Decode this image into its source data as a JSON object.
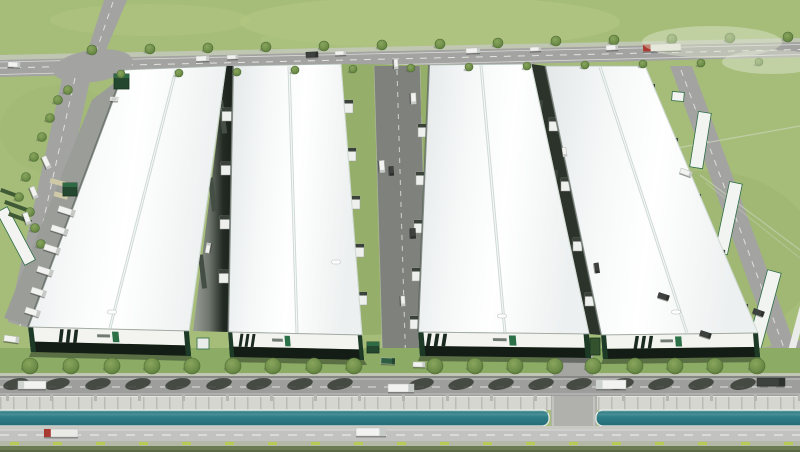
{
  "scene": {
    "title": "Aerial rendering of logistics industrial park",
    "description": "3D architectural aerial rendering of an industrial logistics park: four long white warehouse buildings with dark green facade bands and a small green brand mark, service roads with loading docks and trucks, tree-lined frontage road, a teal drainage canal along the highway, and surrounding green fields.",
    "meta": {
      "warehouse_count": 4,
      "branding": "small green chevron logo with illegible text on each facade"
    },
    "palette": {
      "grass": "#a6bd7a",
      "grass_mid": "#95af6a",
      "grass_dark": "#8cab64",
      "road": "#a3a3a1",
      "road_dark": "#7f827c",
      "road_light": "#c2c2c0",
      "frontage": "#9e9e9c",
      "concrete": "#cfcfc9",
      "water": "#2e7d86",
      "roof": "#f6f7f8",
      "facade_white": "#f3f3f0",
      "facade_dark": "#141d15",
      "green_trim": "#1d3a27",
      "brand_green": "#2c7047",
      "tree": "#6d8d48",
      "shadow": "#2e352d",
      "truck_white": "#f2f3f0",
      "truck_dark": "#3e423e",
      "truck_red": "#a93a31",
      "truck_green": "#2e5e40",
      "marker": "#b8cc55",
      "hedge": "#6d7b53"
    },
    "buildings": [
      {
        "id": "warehouse-1",
        "roof": [
          [
            124,
            70
          ],
          [
            226,
            66
          ],
          [
            189,
            331
          ],
          [
            28,
            327
          ]
        ],
        "facade": [
          [
            28,
            327
          ],
          [
            189,
            331
          ],
          [
            191,
            356
          ],
          [
            31,
            352
          ]
        ],
        "ridge": [
          176,
          70,
          110,
          328
        ],
        "vent": [
          112,
          312
        ],
        "stripes_u": 0.18,
        "logo_u": 0.52
      },
      {
        "id": "warehouse-2",
        "roof": [
          [
            233,
            66
          ],
          [
            341,
            64
          ],
          [
            362,
            335
          ],
          [
            228,
            332
          ]
        ],
        "facade": [
          [
            228,
            332
          ],
          [
            362,
            335
          ],
          [
            364,
            360
          ],
          [
            230,
            357
          ]
        ],
        "ridge": [
          289,
          66,
          297,
          333
        ],
        "vent": [
          336,
          262
        ],
        "stripes_u": 0.07,
        "logo_u": 0.42
      },
      {
        "id": "warehouse-3",
        "roof": [
          [
            429,
            65
          ],
          [
            531,
            64
          ],
          [
            589,
            334
          ],
          [
            418,
            332
          ]
        ],
        "facade": [
          [
            418,
            332
          ],
          [
            589,
            334
          ],
          [
            591,
            358
          ],
          [
            420,
            356
          ]
        ],
        "ridge": [
          481,
          65,
          505,
          333
        ],
        "vent": [
          502,
          316
        ],
        "stripes_u": 0.04,
        "logo_u": 0.53
      },
      {
        "id": "warehouse-4",
        "roof": [
          [
            545,
            66
          ],
          [
            645,
            66
          ],
          [
            758,
            333
          ],
          [
            601,
            335
          ]
        ],
        "facade": [
          [
            601,
            335
          ],
          [
            758,
            333
          ],
          [
            760,
            357
          ],
          [
            603,
            359
          ]
        ],
        "ridge": [
          600,
          67,
          687,
          333
        ],
        "vent": [
          676,
          312
        ],
        "stripes_u": 0.2,
        "logo_u": 0.47
      }
    ],
    "gaps": {
      "gap12": [
        [
          226,
          66
        ],
        [
          233,
          66
        ],
        [
          228,
          332
        ],
        [
          193,
          331
        ]
      ],
      "gap34": [
        [
          531,
          64
        ],
        [
          545,
          66
        ],
        [
          601,
          335
        ],
        [
          589,
          334
        ]
      ],
      "docks12": [
        [
          222,
          108
        ],
        [
          221,
          162
        ],
        [
          220,
          216
        ],
        [
          219,
          270
        ]
      ],
      "docks34": [
        [
          549,
          118
        ],
        [
          561,
          178
        ],
        [
          573,
          238
        ],
        [
          585,
          293
        ]
      ],
      "wallsegs12": [
        [
          218,
          100,
          -7
        ],
        [
          208,
          178,
          -7
        ],
        [
          198,
          255,
          -7
        ]
      ],
      "wallsegs34": [
        [
          538,
          100,
          5
        ],
        [
          553,
          170,
          5
        ],
        [
          569,
          245,
          5
        ]
      ]
    },
    "corridor": {
      "patches_left": [
        [
          358,
          86
        ],
        [
          361,
          176
        ],
        [
          364,
          268
        ]
      ],
      "patches_right": [
        [
          421,
          100
        ],
        [
          423,
          190
        ],
        [
          425,
          280
        ]
      ],
      "docks_west": [
        [
          344,
          100
        ],
        [
          347,
          148
        ],
        [
          351,
          196
        ],
        [
          355,
          244
        ],
        [
          358,
          292
        ]
      ],
      "docks_east": [
        [
          418,
          124
        ],
        [
          416,
          172
        ],
        [
          414,
          220
        ],
        [
          412,
          268
        ],
        [
          410,
          316
        ]
      ],
      "docks_b4east": [
        [
          645,
          84
        ],
        [
          668,
          138
        ],
        [
          691,
          194
        ],
        [
          715,
          250
        ],
        [
          738,
          304
        ]
      ]
    },
    "trees": {
      "top": [
        [
          92,
          50
        ],
        [
          121,
          74
        ],
        [
          150,
          49
        ],
        [
          179,
          73
        ],
        [
          208,
          48
        ],
        [
          237,
          72
        ],
        [
          266,
          47
        ],
        [
          295,
          70
        ],
        [
          324,
          46
        ],
        [
          353,
          69
        ],
        [
          382,
          45
        ],
        [
          411,
          68
        ],
        [
          440,
          44
        ],
        [
          469,
          67
        ],
        [
          498,
          43
        ],
        [
          527,
          66
        ],
        [
          556,
          41
        ],
        [
          585,
          65
        ],
        [
          614,
          40
        ],
        [
          643,
          64
        ],
        [
          672,
          39
        ],
        [
          701,
          63
        ],
        [
          730,
          38
        ],
        [
          759,
          62
        ],
        [
          788,
          37
        ]
      ],
      "left": [
        [
          58,
          100
        ],
        [
          50,
          118
        ],
        [
          42,
          137
        ],
        [
          34,
          157
        ],
        [
          26,
          177
        ],
        [
          19,
          197
        ],
        [
          68,
          90
        ],
        [
          30,
          212
        ],
        [
          35,
          228
        ],
        [
          41,
          244
        ]
      ],
      "front_xs": [
        30,
        71,
        112,
        152,
        192,
        233,
        273,
        314,
        354,
        435,
        475,
        515,
        555,
        593,
        635,
        675,
        715,
        757
      ],
      "front_y": 366,
      "front_r": 8
    },
    "trucks": [
      [
        196,
        56,
        13,
        5,
        -2,
        "white"
      ],
      [
        227,
        55,
        11,
        4,
        -2,
        "white"
      ],
      [
        306,
        52,
        12,
        5,
        -2,
        "dark"
      ],
      [
        335,
        51,
        11,
        4,
        -2,
        "white"
      ],
      [
        466,
        48,
        14,
        5,
        -2,
        "white"
      ],
      [
        530,
        47,
        11,
        4,
        -2,
        "white"
      ],
      [
        606,
        45,
        12,
        5,
        -2,
        "white"
      ],
      [
        643,
        44,
        38,
        7,
        -2,
        "red"
      ],
      [
        8,
        62,
        12,
        5,
        2,
        "white"
      ],
      [
        40,
        160,
        13,
        5,
        65,
        "white"
      ],
      [
        28,
        190,
        12,
        5,
        68,
        "white"
      ],
      [
        21,
        216,
        12,
        5,
        70,
        "white"
      ],
      [
        58,
        208,
        17,
        6,
        18,
        "white"
      ],
      [
        51,
        227,
        17,
        6,
        18,
        "white"
      ],
      [
        44,
        246,
        16,
        6,
        18,
        "white"
      ],
      [
        37,
        268,
        16,
        6,
        18,
        "white"
      ],
      [
        31,
        289,
        15,
        6,
        18,
        "white"
      ],
      [
        25,
        309,
        15,
        6,
        18,
        "white"
      ],
      [
        4,
        336,
        15,
        6,
        8,
        "white"
      ],
      [
        110,
        97,
        8,
        4,
        4,
        "car"
      ],
      [
        203,
        246,
        10,
        4,
        -80,
        "white"
      ],
      [
        560,
        150,
        9,
        4,
        82,
        "white"
      ],
      [
        592,
        266,
        10,
        4,
        82,
        "dark"
      ],
      [
        391,
        62,
        10,
        4,
        87,
        "white"
      ],
      [
        408,
        96,
        11,
        5,
        88,
        "white"
      ],
      [
        376,
        164,
        12,
        5,
        86,
        "white"
      ],
      [
        387,
        169,
        9,
        4,
        86,
        "dark"
      ],
      [
        408,
        231,
        10,
        5,
        88,
        "dark"
      ],
      [
        398,
        299,
        10,
        4,
        87,
        "white"
      ],
      [
        381,
        358,
        14,
        6,
        2,
        "green"
      ],
      [
        413,
        362,
        12,
        5,
        1,
        "white"
      ],
      [
        680,
        170,
        12,
        5,
        20,
        "white"
      ],
      [
        658,
        294,
        11,
        5,
        18,
        "dark"
      ],
      [
        700,
        332,
        11,
        5,
        18,
        "dark"
      ],
      [
        753,
        310,
        11,
        5,
        20,
        "dark"
      ],
      [
        18,
        381,
        28,
        8,
        0,
        "whiteL"
      ],
      [
        388,
        384,
        26,
        8,
        0,
        "white"
      ],
      [
        596,
        380,
        30,
        9,
        0,
        "whiteL"
      ],
      [
        757,
        378,
        28,
        8,
        0,
        "dark"
      ],
      [
        44,
        429,
        34,
        8,
        0,
        "red"
      ],
      [
        356,
        428,
        30,
        8,
        0,
        "white"
      ]
    ],
    "boxes": [
      [
        114,
        74,
        15,
        15,
        "green"
      ],
      [
        63,
        183,
        14,
        13,
        "green"
      ],
      [
        197,
        338,
        12,
        11,
        "white"
      ],
      [
        367,
        342,
        12,
        11,
        "green"
      ],
      [
        590,
        338,
        10,
        17,
        "hedge"
      ]
    ],
    "wall_posts": {
      "start": 6,
      "step": 44,
      "count": 19,
      "y": 394
    },
    "markers": {
      "start": 10,
      "step": 43,
      "count": 19,
      "y": 442
    }
  }
}
